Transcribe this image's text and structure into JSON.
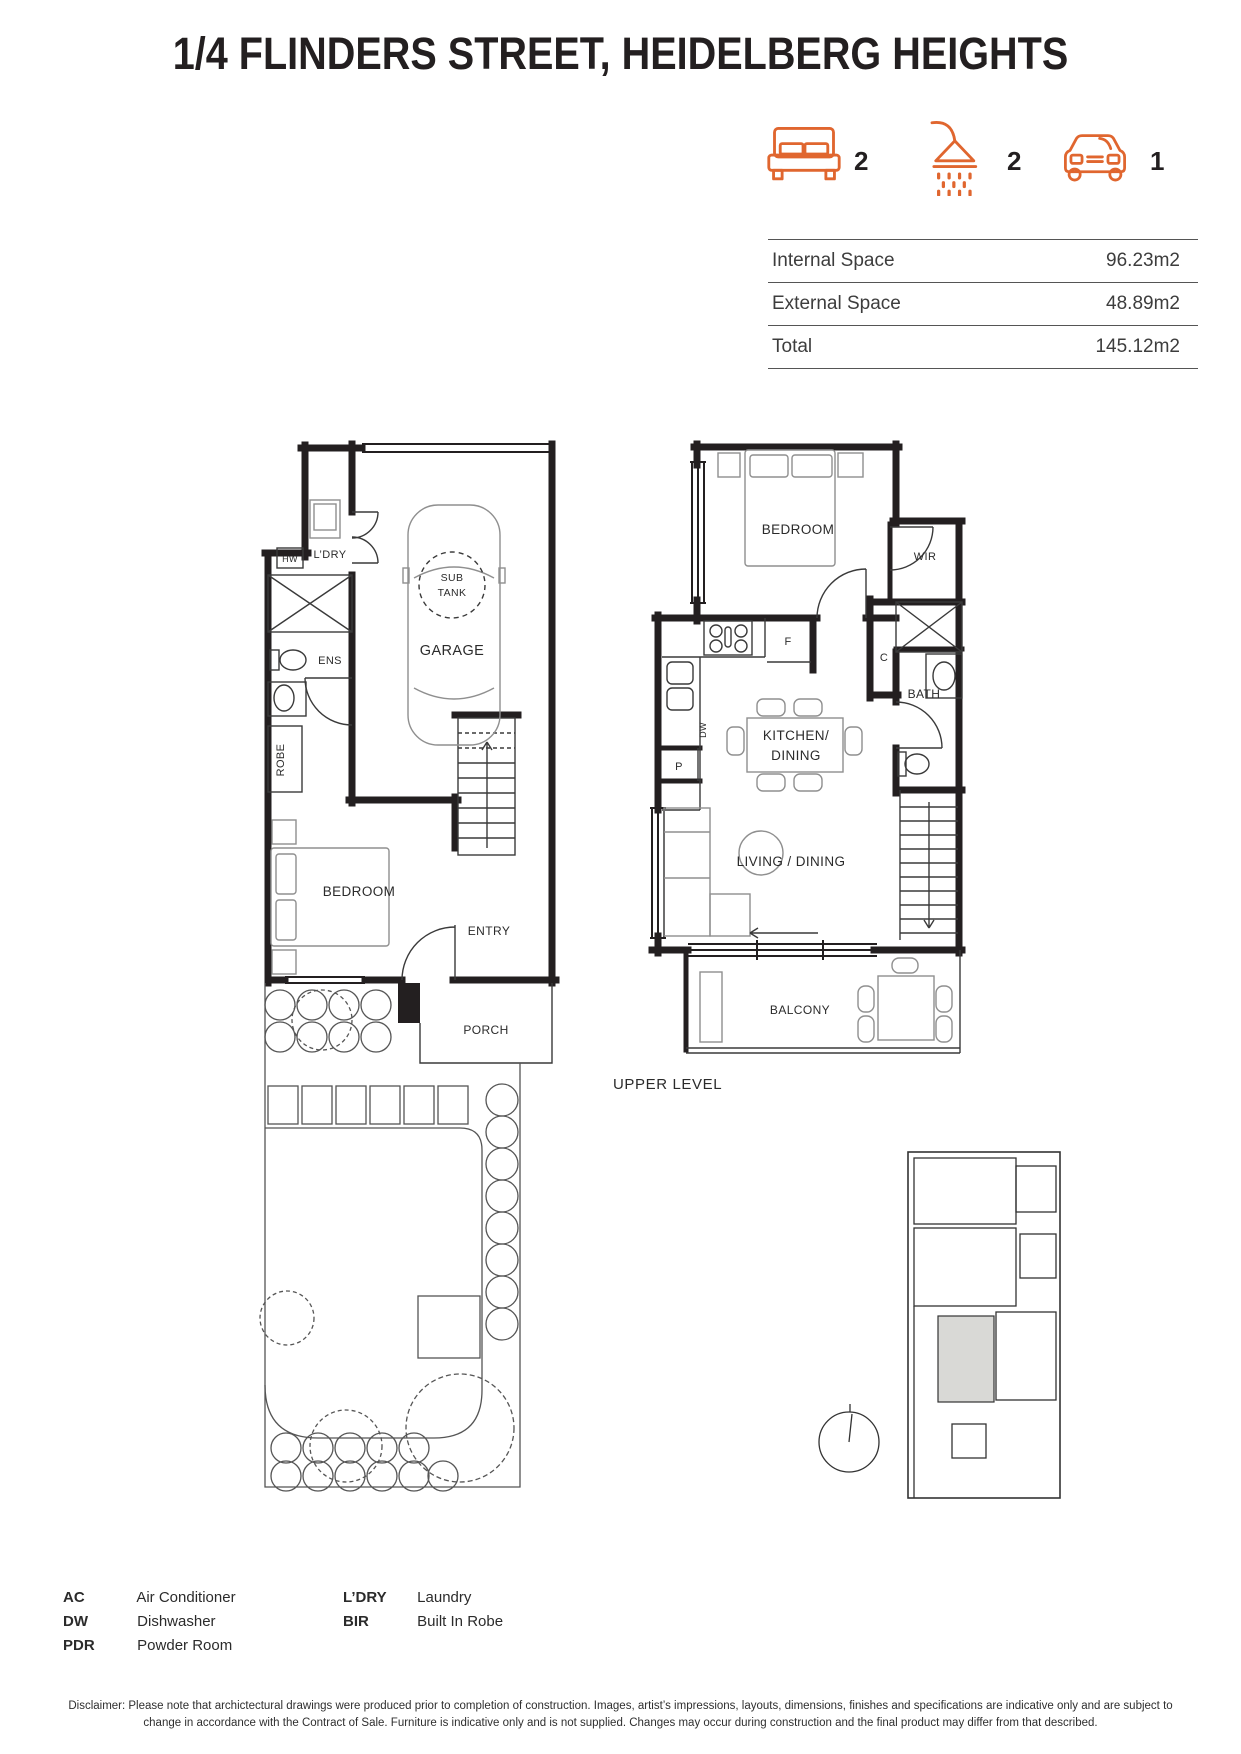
{
  "title": "1/4 FLINDERS STREET, HEIDELBERG HEIGHTS",
  "summary": {
    "beds": "2",
    "baths": "2",
    "cars": "1"
  },
  "stats": {
    "rows": [
      {
        "label": "Internal Space",
        "value": "96.23m2"
      },
      {
        "label": "External Space",
        "value": "48.89m2"
      },
      {
        "label": "Total",
        "value": "145.12m2"
      }
    ]
  },
  "ground_floor": {
    "hw": "HW",
    "laundry": "L’DRY",
    "ens": "ENS",
    "robe": "ROBE",
    "sub": "SUB",
    "tank": "TANK",
    "garage": "GARAGE",
    "bedroom": "BEDROOM",
    "entry": "ENTRY",
    "porch": "PORCH"
  },
  "upper_floor": {
    "bedroom": "BEDROOM",
    "wir": "WIR",
    "fridge": "F",
    "cupboard": "C",
    "bath": "BATH",
    "dishwasher": "DW",
    "pantry": "P",
    "kitchen_line1": "KITCHEN/",
    "kitchen_line2": "DINING",
    "living": "LIVING / DINING",
    "balcony": "BALCONY",
    "level_label": "UPPER LEVEL"
  },
  "legend": {
    "col1": [
      {
        "abbr": "AC",
        "label": "Air Conditioner"
      },
      {
        "abbr": "DW",
        "label": "Dishwasher"
      },
      {
        "abbr": "PDR",
        "label": "Powder Room"
      }
    ],
    "col2": [
      {
        "abbr": "L’DRY",
        "label": "Laundry"
      },
      {
        "abbr": "BIR",
        "label": "Built In Robe"
      }
    ]
  },
  "disclaimer": "Disclaimer: Please note that archictectural drawings were produced prior to completion of construction. Images, artist’s impressions, layouts, dimensions, finishes and specifications are indicative only and are subject to change in accordance with the Contract of Sale. Furniture is indicative only and is not supplied. Changes may occur during construction and the final product may differ from that described.",
  "colors": {
    "accent": "#E0662F",
    "ink": "#231F20"
  }
}
